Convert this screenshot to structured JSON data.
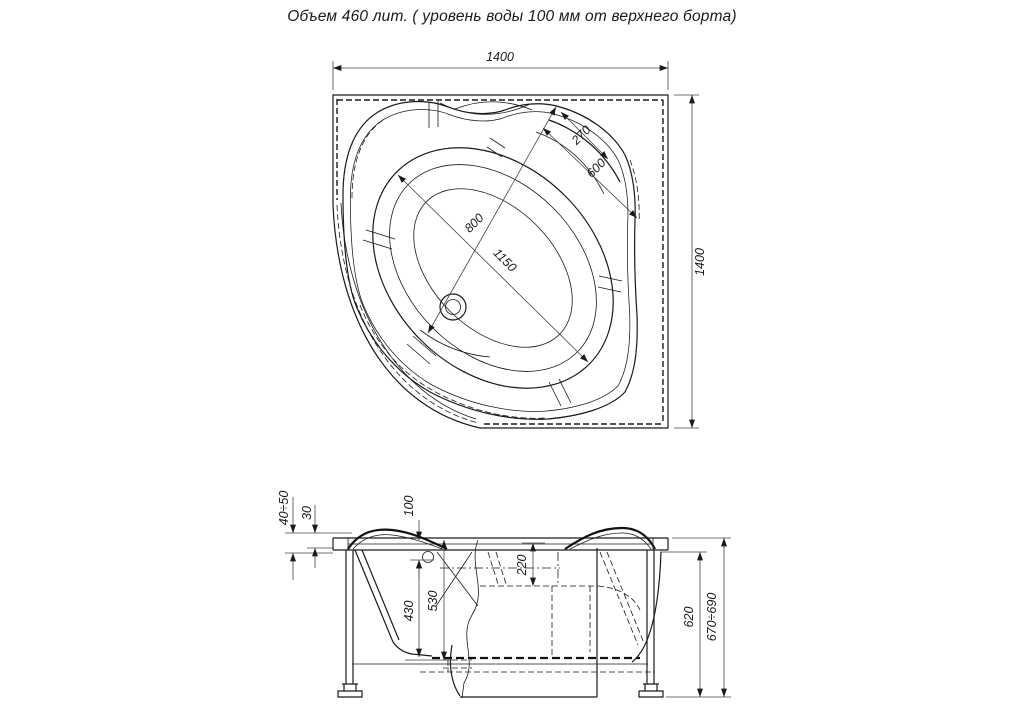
{
  "title": "Объем 460 лит. ( уровень воды 100 мм от верхнего борта)",
  "plan": {
    "width": "1400",
    "height": "1400",
    "seat_270": "270",
    "seat_600": "600",
    "basin_800": "800",
    "basin_1150": "1150"
  },
  "side": {
    "rim_range": "40÷50",
    "rim_lip": "30",
    "water_from_top": "100",
    "seat_depth": "220",
    "water_depth": "430",
    "inner_depth": "530",
    "frame_height": "620",
    "total_height": "670÷690"
  },
  "colors": {
    "line": "#1a1a1a",
    "background": "#ffffff"
  }
}
